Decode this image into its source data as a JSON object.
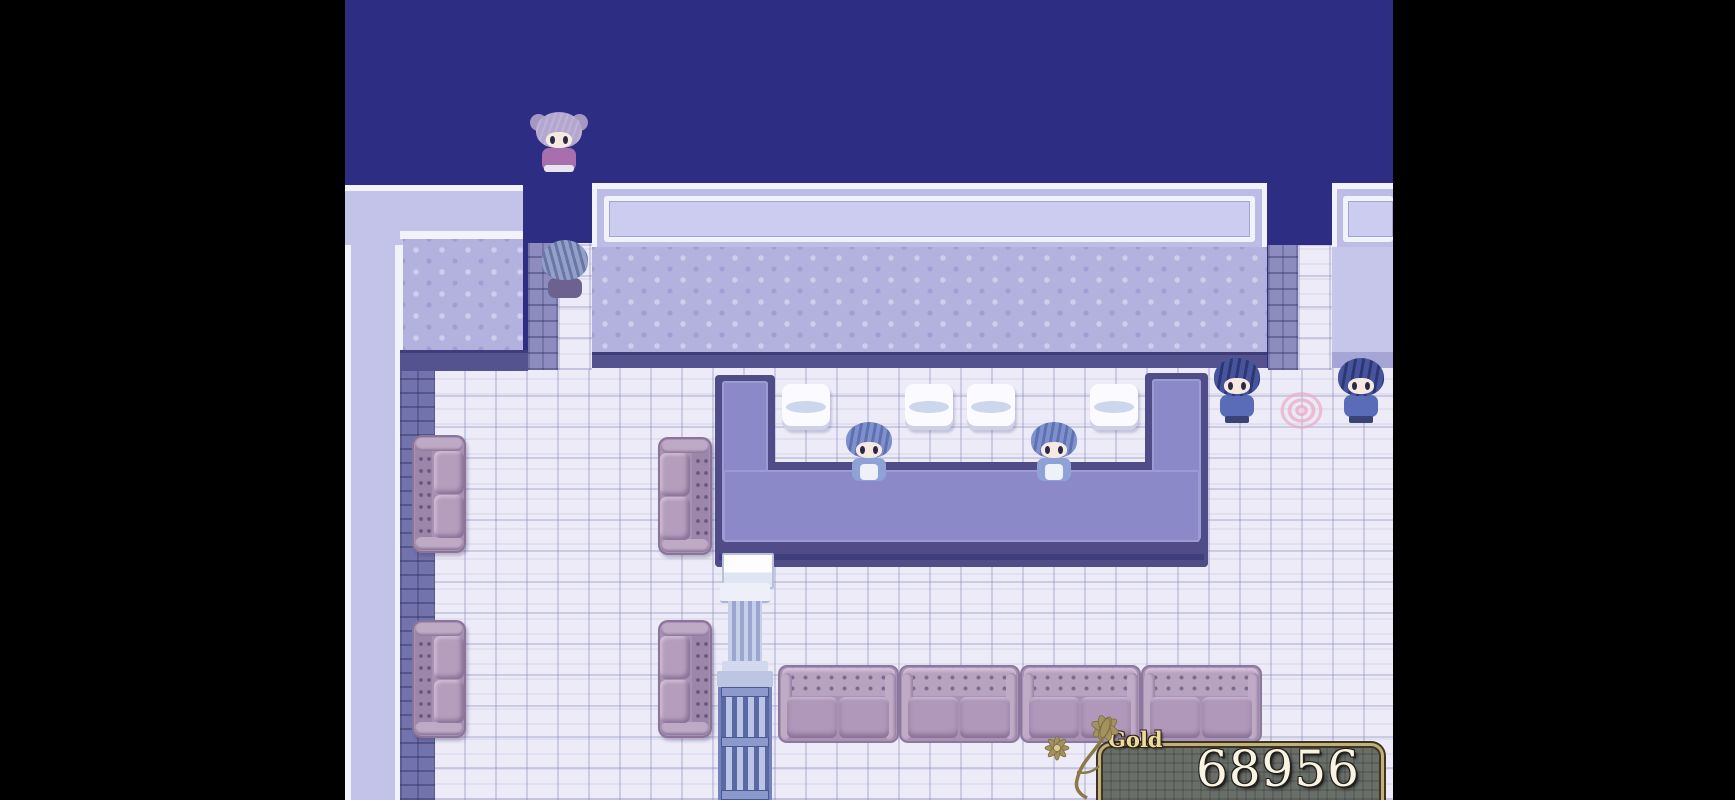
{
  "window": {
    "width": 1735,
    "height": 800
  },
  "hud": {
    "gold": {
      "label": "Gold",
      "value": "68956"
    }
  },
  "scene": {
    "type": "top-down RPG interior (tavern / lounge room)",
    "letterbox_color": "#000000",
    "void_color": "#2d2d84",
    "entities": {
      "player": {
        "desc": "girl with silver twin-bun hair and violet dress, standing in north void",
        "facing": "down"
      },
      "doorway_npc": {
        "desc": "spiky slate-blue haired figure seen from behind in north doorway",
        "facing": "up"
      },
      "attendant_left": {
        "desc": "blue-haired attendant inside bar counter",
        "facing": "down"
      },
      "attendant_right": {
        "desc": "blue-haired attendant inside bar counter",
        "facing": "down"
      },
      "patron_left": {
        "desc": "man in blue coat standing by east wall",
        "facing": "down"
      },
      "patron_right": {
        "desc": "man in blue coat standing by east doorway",
        "facing": "down"
      }
    },
    "furniture": {
      "bar_counter": "U-shaped purple counter",
      "stools": 4,
      "lounge_couches": 4,
      "couch_row_sections": 4,
      "column_stack": "white cabinet, fluted column, slatted rack",
      "rug": "pink round rug"
    }
  },
  "palette": {
    "void": "#2d2d84",
    "wall_top": "#c3c3e9",
    "wall_trim": "#f2f2fb",
    "wall_face": "#b3b1de",
    "wall_edge": "#54538f",
    "floor": "#ecebf7",
    "counter_edge": "#4f4c88",
    "counter_top": "#8b89c7",
    "couch": "#a893b5",
    "stool": "#fafaff",
    "gold_border": "#c2b07e",
    "gold_fill": "#696e69",
    "gold_text": "#f8f3e2"
  }
}
